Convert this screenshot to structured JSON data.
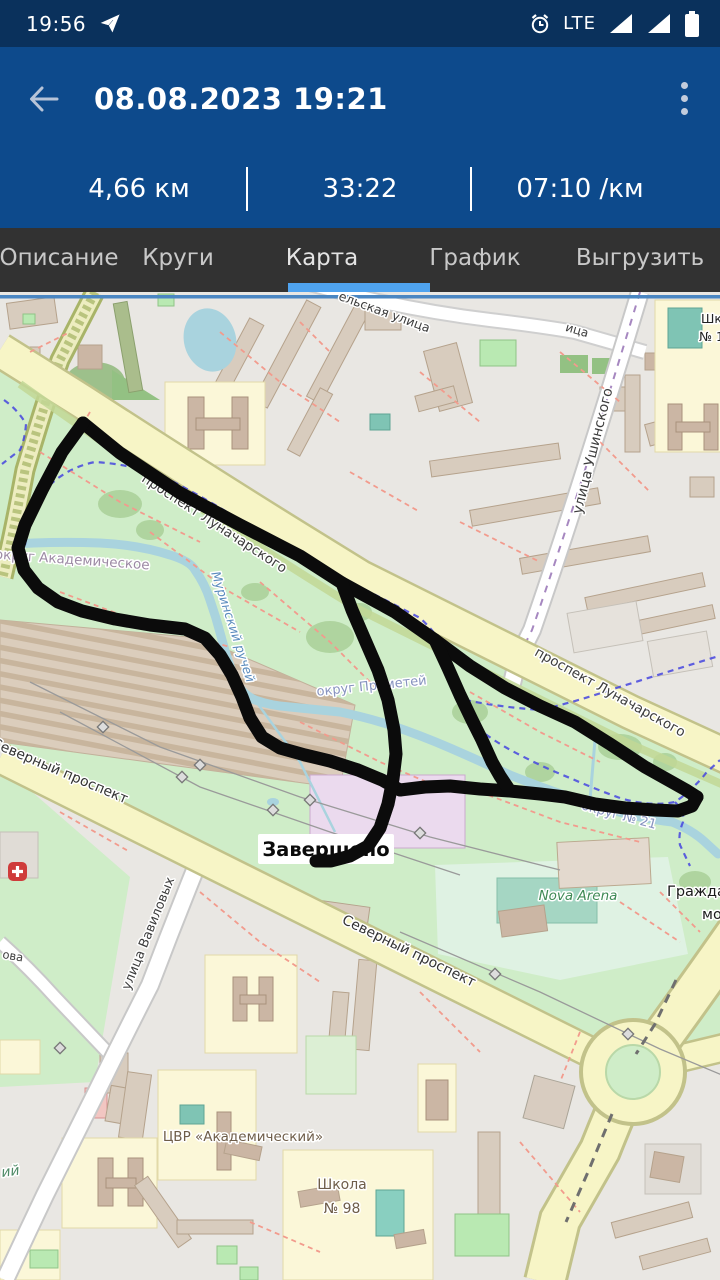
{
  "status_bar": {
    "time": "19:56",
    "network": "LTE"
  },
  "header": {
    "title": "08.08.2023 19:21"
  },
  "stats": [
    {
      "label": "4,66 км"
    },
    {
      "label": "33:22"
    },
    {
      "label": "07:10 /км"
    }
  ],
  "tabs": [
    {
      "label": "Описание",
      "active": false
    },
    {
      "label": "Круги",
      "active": false
    },
    {
      "label": "Карта",
      "active": true
    },
    {
      "label": "График",
      "active": false
    },
    {
      "label": "Выгрузить",
      "active": false
    }
  ],
  "colors": {
    "status_bar": "#0A315C",
    "app_bar": "#0D4A8C",
    "tab_bar": "#323232",
    "tab_indicator": "#4FA3EF",
    "track": "#0B0B0B",
    "park_green": "#CFEDC8",
    "road_yellow": "#F7F5C6",
    "water_blue": "#A9D3DE"
  },
  "map": {
    "finish_marker": "Завершено",
    "labels": [
      {
        "text": "ельская улица",
        "x": 383,
        "y": 24,
        "rot": 20,
        "size": 12.5,
        "color": "#3C3C3C"
      },
      {
        "text": "ица",
        "x": 576,
        "y": 42,
        "rot": 16,
        "size": 12,
        "color": "#3C3C3C"
      },
      {
        "text": "Шко",
        "x": 701,
        "y": 31,
        "rot": 0,
        "size": 12.5,
        "color": "#222222",
        "anchor": "start"
      },
      {
        "text": "№ 1",
        "x": 699,
        "y": 49,
        "rot": 0,
        "size": 12.5,
        "color": "#222222",
        "anchor": "start"
      },
      {
        "text": "улица Ушинского",
        "x": 597,
        "y": 160,
        "rot": -76,
        "size": 14,
        "color": "#3C3C3C"
      },
      {
        "text": "проспект Луначарского",
        "x": 212,
        "y": 235,
        "rot": 33,
        "size": 13.5,
        "color": "#3C3C3C"
      },
      {
        "text": "проспект Луначарского",
        "x": 608,
        "y": 404,
        "rot": 29,
        "size": 13.5,
        "color": "#3C3C3C"
      },
      {
        "text": "округ Академическое",
        "x": 72,
        "y": 272,
        "rot": 4,
        "size": 13.5,
        "color": "#9C8AA4"
      },
      {
        "text": "Муринский ручей",
        "x": 229,
        "y": 336,
        "rot": 72,
        "size": 12.5,
        "color": "#5B8CBE",
        "italic": true
      },
      {
        "text": "округ Прометей",
        "x": 372,
        "y": 398,
        "rot": -6,
        "size": 13,
        "color": "#8793BF"
      },
      {
        "text": "округ № 21",
        "x": 618,
        "y": 527,
        "rot": 15,
        "size": 13,
        "color": "#8793BF"
      },
      {
        "text": "Северный проспект",
        "x": 58,
        "y": 483,
        "rot": 23,
        "size": 14,
        "color": "#333333"
      },
      {
        "text": "Северный проспект",
        "x": 407,
        "y": 663,
        "rot": 26,
        "size": 14,
        "color": "#333333"
      },
      {
        "text": "улица Вавиловых",
        "x": 152,
        "y": 643,
        "rot": -68,
        "size": 13,
        "color": "#3C3C3C"
      },
      {
        "text": "ЦВР «Академический»",
        "x": 243,
        "y": 849,
        "rot": 0,
        "size": 13.5,
        "color": "#6E5D49"
      },
      {
        "text": "Школа",
        "x": 342,
        "y": 897,
        "rot": 0,
        "size": 14,
        "color": "#6E5D49"
      },
      {
        "text": "№ 98",
        "x": 342,
        "y": 921,
        "rot": 0,
        "size": 14,
        "color": "#6E5D49"
      },
      {
        "text": "Nova Arena",
        "x": 578,
        "y": 608,
        "rot": 0,
        "size": 13.5,
        "color": "#3F8A55",
        "italic": true
      },
      {
        "text": "Гражда",
        "x": 667,
        "y": 604,
        "rot": 0,
        "size": 14.5,
        "color": "#1A1A1A",
        "anchor": "start"
      },
      {
        "text": "мо",
        "x": 702,
        "y": 627,
        "rot": 0,
        "size": 14.5,
        "color": "#1A1A1A",
        "anchor": "start"
      },
      {
        "text": "ова",
        "x": 2,
        "y": 666,
        "rot": 10,
        "size": 11.5,
        "color": "#3C3C3C",
        "anchor": "start"
      },
      {
        "text": "ий",
        "x": 2,
        "y": 885,
        "rot": -8,
        "size": 14,
        "color": "#4E8A66",
        "italic": true,
        "anchor": "start"
      }
    ],
    "track": {
      "color": "#0B0B0B",
      "width": 13,
      "segments": [
        [
          [
            83,
            131
          ],
          [
            120,
            161
          ],
          [
            180,
            201
          ],
          [
            240,
            233
          ],
          [
            300,
            264
          ],
          [
            342,
            291
          ],
          [
            395,
            320
          ],
          [
            435,
            348
          ],
          [
            470,
            374
          ],
          [
            505,
            396
          ],
          [
            540,
            414
          ],
          [
            575,
            430
          ],
          [
            610,
            452
          ],
          [
            645,
            475
          ],
          [
            670,
            489
          ],
          [
            686,
            498
          ],
          [
            697,
            505
          ]
        ],
        [
          [
            697,
            505
          ],
          [
            692,
            514
          ],
          [
            678,
            519
          ],
          [
            655,
            518
          ],
          [
            625,
            516
          ],
          [
            595,
            512
          ],
          [
            565,
            505
          ],
          [
            540,
            502
          ],
          [
            510,
            499
          ],
          [
            480,
            497
          ],
          [
            450,
            494
          ],
          [
            425,
            495
          ],
          [
            400,
            498
          ]
        ],
        [
          [
            83,
            131
          ],
          [
            62,
            160
          ],
          [
            42,
            198
          ],
          [
            25,
            233
          ],
          [
            18,
            256
          ],
          [
            24,
            278
          ],
          [
            38,
            296
          ],
          [
            58,
            310
          ],
          [
            82,
            319
          ],
          [
            115,
            327
          ],
          [
            150,
            333
          ],
          [
            185,
            337
          ],
          [
            205,
            346
          ],
          [
            220,
            363
          ],
          [
            232,
            383
          ],
          [
            242,
            405
          ],
          [
            250,
            426
          ],
          [
            262,
            445
          ],
          [
            280,
            456
          ],
          [
            305,
            463
          ],
          [
            330,
            469
          ],
          [
            358,
            478
          ],
          [
            382,
            488
          ],
          [
            400,
            498
          ]
        ],
        [
          [
            435,
            348
          ],
          [
            448,
            376
          ],
          [
            460,
            403
          ],
          [
            472,
            428
          ],
          [
            482,
            448
          ],
          [
            492,
            470
          ],
          [
            500,
            484
          ],
          [
            508,
            496
          ]
        ],
        [
          [
            342,
            291
          ],
          [
            352,
            318
          ],
          [
            365,
            348
          ],
          [
            378,
            378
          ],
          [
            388,
            408
          ],
          [
            394,
            438
          ],
          [
            396,
            462
          ],
          [
            393,
            487
          ],
          [
            388,
            512
          ],
          [
            380,
            536
          ],
          [
            368,
            554
          ],
          [
            350,
            564
          ],
          [
            331,
            569
          ],
          [
            316,
            569
          ]
        ]
      ]
    }
  }
}
